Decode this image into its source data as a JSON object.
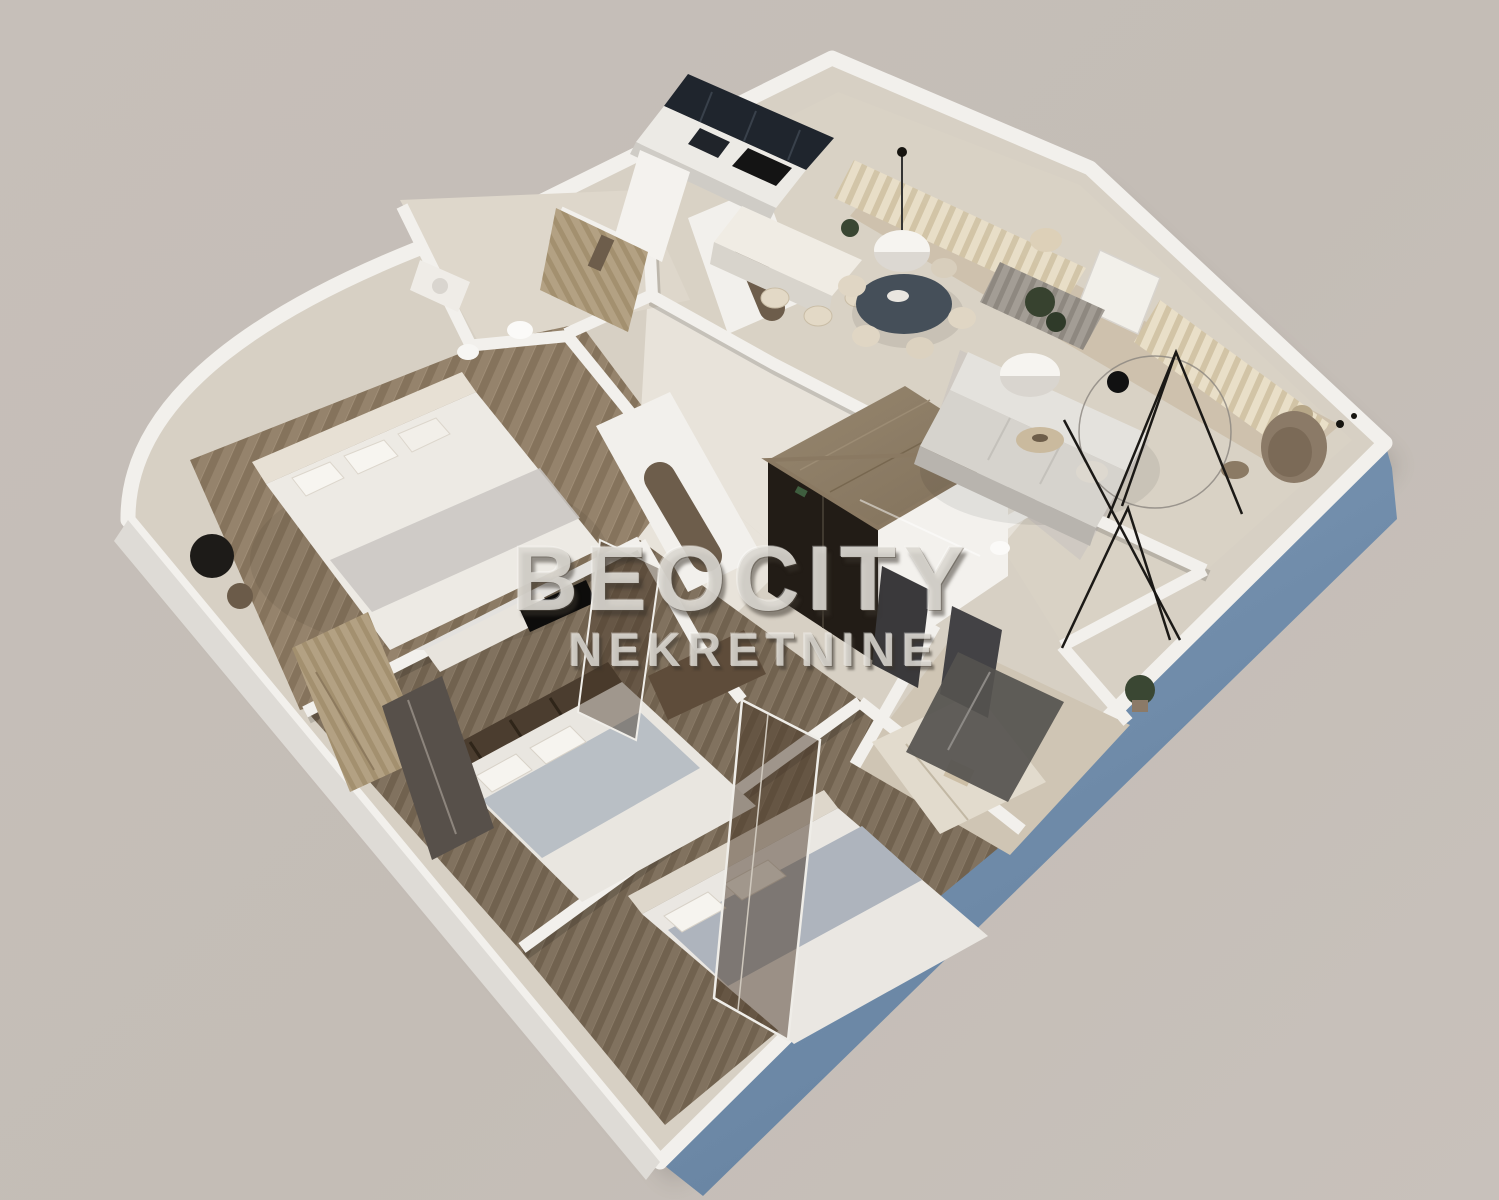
{
  "watermark": {
    "line1": "BEOCITY",
    "line2": "NEKRETNINE"
  },
  "palette": {
    "background": "#c4bdb6",
    "wall_top": "#f2f0ec",
    "wall_shade": "#d8d4cf",
    "exterior_blue": "#7390ae",
    "kitchen_floor": "#d9d2c5",
    "hall_marble": "#e8e3da",
    "master_wood_floor": "#95836c",
    "bedroom_herringbone": "#837363",
    "dark_kitchen_cabinet": "#1f252d",
    "closet_top": "#8f7f68",
    "closet_front_dark": "#221c16",
    "sofa": "#d6d3cd",
    "dining_table": "#454f59",
    "curtain_beige": "#e9dfc8",
    "curtain_gray": "#a39d95",
    "bedding_white": "#eae7e2",
    "blanket_gray": "#aeb4bd",
    "glass_tint": "rgba(75,58,42,0.5)",
    "decor_black": "#16140f",
    "plant_green": "#3a4733"
  },
  "scene": {
    "type": "3d-apartment-floor-plan-render",
    "elements": [
      "kitchen-cabinets",
      "kitchen-island",
      "dining-table",
      "pendant-lamp",
      "curtain-wall",
      "living-sofa",
      "dome-floor-lamp",
      "wire-decor",
      "lounge-chair",
      "central-closet-box",
      "master-bed",
      "side-table",
      "bathroom-fixtures",
      "arched-doorways",
      "bedroom2-bed",
      "bedroom3-bed",
      "glass-partition",
      "wardrobe",
      "shower-room",
      "plants",
      "blue-exterior-wall"
    ]
  }
}
